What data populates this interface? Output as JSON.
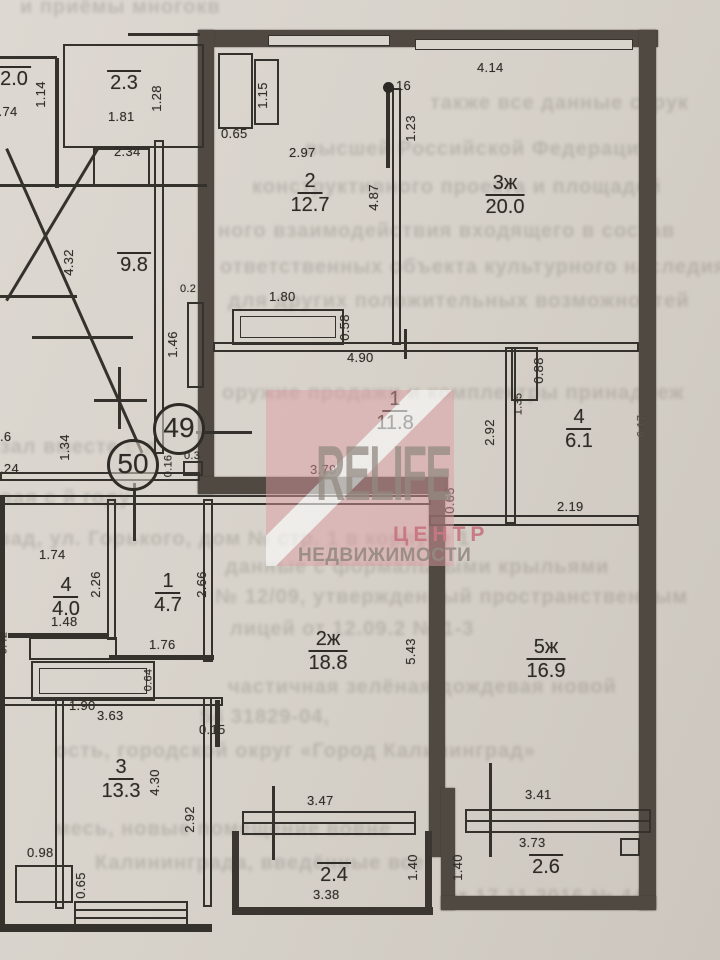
{
  "units": [
    {
      "number": "49"
    },
    {
      "number": "50"
    }
  ],
  "rooms": [
    {
      "num": "2",
      "area": "12.7"
    },
    {
      "num": "3ж",
      "area": "20.0"
    },
    {
      "num": "1",
      "area": "11.8"
    },
    {
      "num": "4",
      "area": "6.1"
    },
    {
      "num": "5ж",
      "area": "16.9"
    },
    {
      "num": "4",
      "area": "4.0"
    },
    {
      "num": "1",
      "area": "4.7"
    },
    {
      "num": "2ж",
      "area": "18.8"
    },
    {
      "num": "3",
      "area": "13.3"
    },
    {
      "area": "2.4"
    },
    {
      "area": "2.6"
    },
    {
      "area": "2.3"
    },
    {
      "area": "9.8"
    },
    {
      "area": "2.0"
    }
  ],
  "dims": [
    {
      "v": "1.74"
    },
    {
      "v": "1.14"
    },
    {
      "v": "1.28"
    },
    {
      "v": "1.81"
    },
    {
      "v": "2.34"
    },
    {
      "v": "4.32"
    },
    {
      "v": "0.2"
    },
    {
      "v": "1.46"
    },
    {
      "v": "1.34"
    },
    {
      "v": ".6"
    },
    {
      "v": ".24"
    },
    {
      "v": "1.15"
    },
    {
      "v": "0.65"
    },
    {
      "v": "2.97"
    },
    {
      "v": "4.87"
    },
    {
      "v": "16"
    },
    {
      "v": "1.23"
    },
    {
      "v": "4.14"
    },
    {
      "v": "1.80"
    },
    {
      "v": "0.58"
    },
    {
      "v": "4.90"
    },
    {
      "v": "0.88"
    },
    {
      "v": "1.35"
    },
    {
      "v": "2.92"
    },
    {
      "v": "2.19"
    },
    {
      "v": "6.17"
    },
    {
      "v": "3.79"
    },
    {
      "v": "0.65"
    },
    {
      "v": "0.3"
    },
    {
      "v": "0.16"
    },
    {
      "v": "5.43"
    },
    {
      "v": "3.41"
    },
    {
      "v": "3.73"
    },
    {
      "v": "1.40"
    },
    {
      "v": "1.74"
    },
    {
      "v": "2.26"
    },
    {
      "v": "2.66"
    },
    {
      "v": "1.48"
    },
    {
      "v": "1.76"
    },
    {
      "v": "0.64"
    },
    {
      "v": "1.90"
    },
    {
      "v": "3.63"
    },
    {
      "v": "0.42"
    },
    {
      "v": "0.15"
    },
    {
      "v": "4.30"
    },
    {
      "v": "2.92"
    },
    {
      "v": "0.98"
    },
    {
      "v": "0.65"
    },
    {
      "v": "3.47"
    },
    {
      "v": "3.38"
    },
    {
      "v": "1.40"
    }
  ],
  "watermark": {
    "brand": "RELIFE",
    "sub1": "ЦЕНТР",
    "sub2": "НЕДВИЖИМОСТИ",
    "pink": "#df9ca4",
    "gray": "#928a81"
  },
  "bleed": [
    {
      "t": "и приёмы многокв"
    },
    {
      "t": "также все данные струк"
    },
    {
      "t": "высшей Российской Федерации"
    },
    {
      "t": "конструктивного проекта и площадей"
    },
    {
      "t": "ного взаимодействия входящего в состав"
    },
    {
      "t": "ответственных объекта культурного наследия"
    },
    {
      "t": "для других положительных возможностей"
    },
    {
      "t": "оружие продажи и комплектры принадлеж"
    },
    {
      "t": "зал вместе с д"
    },
    {
      "t": "вая с й году"
    },
    {
      "t": "зад, ул. Горького, дом № стр. 1 в корпусе 1"
    },
    {
      "t": "данные с формальными крыльями"
    },
    {
      "t": "№ 12/09, утвержденный пространственным"
    },
    {
      "t": "лицей от 12.09.2  № 1-3"
    },
    {
      "t": "частичная зелёная дождевая новой"
    },
    {
      "t": "54 31829-04,"
    },
    {
      "t": "ость, городской округ «Город Калининград»"
    },
    {
      "t": "месь, новые помещение вовне"
    },
    {
      "t": "Калининграда, введённые все"
    },
    {
      "t": "от 17.11.2016 № 44"
    }
  ]
}
